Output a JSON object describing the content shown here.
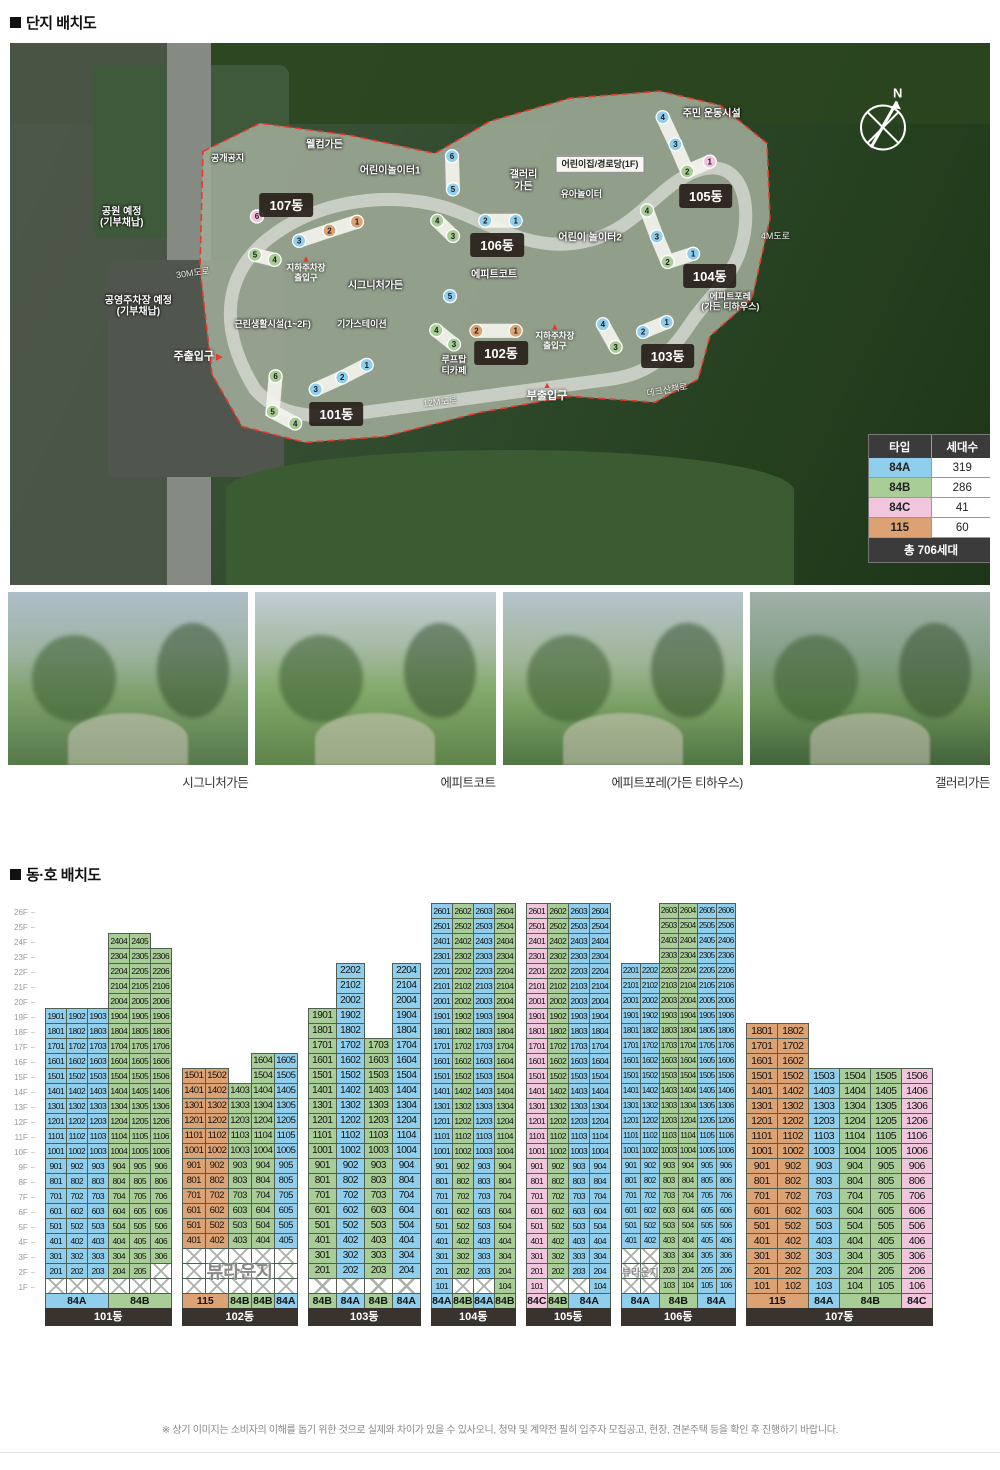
{
  "page": {
    "section1_title": "단지 배치도",
    "section2_title": "동·호 배치도",
    "compass_label": "N",
    "disclaimer": "※ 상기 이미지는 소비자의 이해를 돕기 위한 것으로 실제와 차이가 있을 수 있사오니, 청약 및 계약전 필히 입주자 모집공고, 현장, 견본주택 등을 확인 후 진행하기 바랍니다."
  },
  "type_colors": {
    "84A": "#8FCEEC",
    "84B": "#A9CD96",
    "84C": "#F1C6DD",
    "115": "#DCA273"
  },
  "legend": {
    "col_type": "타입",
    "col_count": "세대수",
    "rows": [
      {
        "type": "84A",
        "count": "319"
      },
      {
        "type": "84B",
        "count": "286"
      },
      {
        "type": "84C",
        "count": "41"
      },
      {
        "type": "115",
        "count": "60"
      }
    ],
    "total": "총 706세대"
  },
  "map": {
    "labels": [
      {
        "text": "공개공지",
        "kind": "outline-sm",
        "x": 22.2,
        "y": 21.3
      },
      {
        "text": "웰컴가든",
        "kind": "outline",
        "x": 32.1,
        "y": 18.9
      },
      {
        "text": "어린이놀이터1",
        "kind": "outline",
        "x": 38.8,
        "y": 23.7
      },
      {
        "text": "갤러리\n가든",
        "kind": "outline",
        "x": 52.4,
        "y": 25.5
      },
      {
        "text": "주민 운동시설",
        "kind": "outline",
        "x": 71.6,
        "y": 13.1
      },
      {
        "text": "어린이집/경로당(1F)",
        "kind": "box",
        "x": 60.2,
        "y": 22.4
      },
      {
        "text": "유아놀이터",
        "kind": "outline-sm",
        "x": 58.3,
        "y": 27.8
      },
      {
        "text": "어린이 놀이터2",
        "kind": "outline",
        "x": 59.2,
        "y": 35.9
      },
      {
        "text": "에피트코트",
        "kind": "outline",
        "x": 49.4,
        "y": 42.8
      },
      {
        "text": "시그니처가든",
        "kind": "outline",
        "x": 37.3,
        "y": 44.8
      },
      {
        "text": "기가스테이션",
        "kind": "outline-sm",
        "x": 35.9,
        "y": 51.9
      },
      {
        "text": "루프탑\n티카페",
        "kind": "outline-sm",
        "x": 45.3,
        "y": 59.5
      },
      {
        "text": "에피트포레\n(가든 티하우스)",
        "kind": "outline-sm",
        "x": 73.5,
        "y": 47.8
      },
      {
        "text": "데크산책로",
        "kind": "road",
        "x": 67.0,
        "y": 64.1,
        "rot": -10
      },
      {
        "text": "12M도로",
        "kind": "road",
        "x": 43.9,
        "y": 66.3,
        "rot": -6
      },
      {
        "text": "4M도로",
        "kind": "road",
        "x": 78.1,
        "y": 35.7,
        "rot": 0
      },
      {
        "text": "30M도로",
        "kind": "road",
        "x": 18.7,
        "y": 42.4,
        "rot": -8
      },
      {
        "text": "공원 예정\n(기부채납)",
        "kind": "outline",
        "x": 11.4,
        "y": 32.2
      },
      {
        "text": "공영주차장 예정\n(기부채납)",
        "kind": "outline",
        "x": 13.1,
        "y": 48.7
      },
      {
        "text": "근린생활시설(1~2F)",
        "kind": "outline-sm",
        "x": 26.8,
        "y": 51.9
      },
      {
        "text": "주출입구",
        "kind": "gate-r",
        "x": 19.2,
        "y": 58.0
      },
      {
        "text": "부출입구",
        "kind": "gate-u",
        "x": 54.8,
        "y": 64.3
      },
      {
        "text": "지하주차장\n출입구",
        "kind": "gate-s",
        "x": 30.2,
        "y": 41.7
      },
      {
        "text": "지하주차장\n출입구",
        "kind": "gate-s",
        "x": 55.6,
        "y": 54.3
      }
    ],
    "badges": [
      {
        "name": "101동",
        "x": 33.3,
        "y": 68.5
      },
      {
        "name": "102동",
        "x": 50.1,
        "y": 57.2
      },
      {
        "name": "103동",
        "x": 67.1,
        "y": 57.8
      },
      {
        "name": "104동",
        "x": 71.4,
        "y": 43.0
      },
      {
        "name": "105동",
        "x": 71.0,
        "y": 28.3
      },
      {
        "name": "106동",
        "x": 49.7,
        "y": 37.2
      },
      {
        "name": "107동",
        "x": 28.2,
        "y": 29.8
      }
    ],
    "map_buildings": [
      {
        "name": "101동",
        "units": [
          {
            "n": 1,
            "t": "84A",
            "x": 36.4,
            "y": 59.4
          },
          {
            "n": 2,
            "t": "84A",
            "x": 33.9,
            "y": 61.7
          },
          {
            "n": 3,
            "t": "84A",
            "x": 31.2,
            "y": 63.9
          },
          {
            "n": 6,
            "t": "84B",
            "x": 27.1,
            "y": 61.5
          },
          {
            "n": 5,
            "t": "84B",
            "x": 26.8,
            "y": 68.0
          },
          {
            "n": 4,
            "t": "84B",
            "x": 29.1,
            "y": 70.2
          }
        ],
        "strips": [
          [
            0,
            1,
            2
          ],
          [
            3,
            4,
            5
          ]
        ]
      },
      {
        "name": "102동",
        "units": [
          {
            "n": 5,
            "t": "84A",
            "x": 44.9,
            "y": 46.7
          },
          {
            "n": 4,
            "t": "84B",
            "x": 43.5,
            "y": 53.0
          },
          {
            "n": 3,
            "t": "84B",
            "x": 45.3,
            "y": 55.6
          },
          {
            "n": 2,
            "t": "115",
            "x": 47.6,
            "y": 53.1
          },
          {
            "n": 1,
            "t": "115",
            "x": 51.6,
            "y": 53.1
          }
        ],
        "strips": [
          [
            1,
            2
          ],
          [
            3,
            4
          ]
        ]
      },
      {
        "name": "103동",
        "units": [
          {
            "n": 4,
            "t": "84A",
            "x": 60.5,
            "y": 51.9
          },
          {
            "n": 3,
            "t": "84B",
            "x": 61.8,
            "y": 56.1
          },
          {
            "n": 2,
            "t": "84A",
            "x": 64.6,
            "y": 53.3
          },
          {
            "n": 1,
            "t": "84A",
            "x": 67.0,
            "y": 51.5
          }
        ],
        "strips": [
          [
            0,
            1
          ],
          [
            2,
            3
          ]
        ]
      },
      {
        "name": "104동",
        "units": [
          {
            "n": 4,
            "t": "84B",
            "x": 65.0,
            "y": 30.9
          },
          {
            "n": 3,
            "t": "84A",
            "x": 66.0,
            "y": 35.7
          },
          {
            "n": 2,
            "t": "84B",
            "x": 67.1,
            "y": 40.4
          },
          {
            "n": 1,
            "t": "84A",
            "x": 69.7,
            "y": 38.9
          }
        ],
        "strips": [
          [
            0,
            1,
            2
          ],
          [
            2,
            3
          ]
        ]
      },
      {
        "name": "105동",
        "units": [
          {
            "n": 4,
            "t": "84A",
            "x": 66.6,
            "y": 13.7
          },
          {
            "n": 3,
            "t": "84A",
            "x": 67.9,
            "y": 18.7
          },
          {
            "n": 2,
            "t": "84B",
            "x": 69.1,
            "y": 23.7
          },
          {
            "n": 1,
            "t": "84C",
            "x": 71.4,
            "y": 21.9
          }
        ],
        "strips": [
          [
            0,
            1,
            2
          ],
          [
            2,
            3
          ]
        ]
      },
      {
        "name": "106동",
        "units": [
          {
            "n": 6,
            "t": "84A",
            "x": 45.1,
            "y": 20.9
          },
          {
            "n": 5,
            "t": "84A",
            "x": 45.2,
            "y": 27.0
          },
          {
            "n": 4,
            "t": "84B",
            "x": 43.6,
            "y": 32.8
          },
          {
            "n": 3,
            "t": "84B",
            "x": 45.2,
            "y": 35.6
          },
          {
            "n": 2,
            "t": "84A",
            "x": 48.5,
            "y": 32.8
          },
          {
            "n": 1,
            "t": "84A",
            "x": 51.6,
            "y": 32.8
          }
        ],
        "strips": [
          [
            0,
            1
          ],
          [
            2,
            3
          ],
          [
            4,
            5
          ]
        ]
      },
      {
        "name": "107동",
        "units": [
          {
            "n": 6,
            "t": "84C",
            "x": 25.2,
            "y": 32.0
          },
          {
            "n": 3,
            "t": "84A",
            "x": 29.5,
            "y": 36.5
          },
          {
            "n": 2,
            "t": "115",
            "x": 32.6,
            "y": 34.6
          },
          {
            "n": 1,
            "t": "115",
            "x": 35.4,
            "y": 33.0
          },
          {
            "n": 5,
            "t": "84B",
            "x": 25.0,
            "y": 39.1
          },
          {
            "n": 4,
            "t": "84B",
            "x": 27.0,
            "y": 40.0
          }
        ],
        "strips": [
          [
            1,
            2,
            3
          ],
          [
            4,
            5
          ]
        ]
      }
    ]
  },
  "photos": [
    {
      "caption": "시그니처가든"
    },
    {
      "caption": "에피트코트"
    },
    {
      "caption": "에피트포레(가든 티하우스)"
    },
    {
      "caption": "갤러리가든"
    }
  ],
  "chart_data": {
    "type": "table",
    "title": "동·호 배치도",
    "floors": [
      "26F",
      "25F",
      "24F",
      "23F",
      "22F",
      "21F",
      "20F",
      "19F",
      "18F",
      "17F",
      "16F",
      "15F",
      "14F",
      "13F",
      "12F",
      "11F",
      "10F",
      "9F",
      "8F",
      "7F",
      "6F",
      "5F",
      "4F",
      "3F",
      "2F",
      "1F"
    ],
    "unit_number_rule": "floor*100 + column_index",
    "lounge_label": "뷰라운지",
    "buildings": [
      {
        "id": "b101",
        "name": "101동",
        "columns": [
          {
            "type": "84A",
            "top": 19,
            "bottom": 2
          },
          {
            "type": "84A",
            "top": 19,
            "bottom": 2
          },
          {
            "type": "84A",
            "top": 19,
            "bottom": 2
          },
          {
            "type": "84B",
            "top": 24,
            "bottom": 2
          },
          {
            "type": "84B",
            "top": 24,
            "bottom": 2
          },
          {
            "type": "84B",
            "top": 23,
            "bottom": 3
          }
        ],
        "labels": [
          {
            "text": "84A",
            "type": "84A",
            "span": 3
          },
          {
            "text": "84B",
            "type": "84B",
            "span": 3
          }
        ],
        "lounge": null
      },
      {
        "id": "b102",
        "name": "102동",
        "columns": [
          {
            "type": "115",
            "top": 15,
            "bottom": 4
          },
          {
            "type": "115",
            "top": 15,
            "bottom": 4
          },
          {
            "type": "84B",
            "top": 14,
            "bottom": 4
          },
          {
            "type": "84B",
            "top": 16,
            "bottom": 4
          },
          {
            "type": "84A",
            "top": 16,
            "bottom": 4
          }
        ],
        "labels": [
          {
            "text": "115",
            "type": "115",
            "span": 2
          },
          {
            "text": "84B",
            "type": "84B",
            "span": 1
          },
          {
            "text": "84B",
            "type": "84B",
            "span": 1
          },
          {
            "text": "84A",
            "type": "84A",
            "span": 1
          }
        ],
        "lounge": {
          "col_start": 1,
          "col_span": 5,
          "font": 18
        }
      },
      {
        "id": "b103",
        "name": "103동",
        "columns": [
          {
            "type": "84B",
            "top": 19,
            "bottom": 2
          },
          {
            "type": "84A",
            "top": 22,
            "bottom": 2
          },
          {
            "type": "84B",
            "top": 17,
            "bottom": 2
          },
          {
            "type": "84A",
            "top": 22,
            "bottom": 2
          }
        ],
        "labels": [
          {
            "text": "84B",
            "type": "84B",
            "span": 1
          },
          {
            "text": "84A",
            "type": "84A",
            "span": 1
          },
          {
            "text": "84B",
            "type": "84B",
            "span": 1
          },
          {
            "text": "84A",
            "type": "84A",
            "span": 1
          }
        ],
        "lounge": null
      },
      {
        "id": "b104",
        "name": "104동",
        "columns": [
          {
            "type": "84A",
            "top": 26,
            "bottom": 1
          },
          {
            "type": "84B",
            "top": 26,
            "bottom": 2
          },
          {
            "type": "84A",
            "top": 26,
            "bottom": 2
          },
          {
            "type": "84B",
            "top": 26,
            "bottom": 1
          }
        ],
        "labels": [
          {
            "text": "84A",
            "type": "84A",
            "span": 1
          },
          {
            "text": "84B",
            "type": "84B",
            "span": 1
          },
          {
            "text": "84A",
            "type": "84A",
            "span": 1
          },
          {
            "text": "84B",
            "type": "84B",
            "span": 1
          }
        ],
        "lounge": null
      },
      {
        "id": "b105",
        "name": "105동",
        "columns": [
          {
            "type": "84C",
            "top": 26,
            "bottom": 1
          },
          {
            "type": "84B",
            "top": 26,
            "bottom": 2
          },
          {
            "type": "84A",
            "top": 26,
            "bottom": 2
          },
          {
            "type": "84A",
            "top": 26,
            "bottom": 1
          }
        ],
        "labels": [
          {
            "text": "84C",
            "type": "84C",
            "span": 1
          },
          {
            "text": "84B",
            "type": "84B",
            "span": 1
          },
          {
            "text": "84A",
            "type": "84A",
            "span": 2
          }
        ],
        "lounge": null
      },
      {
        "id": "b106",
        "name": "106동",
        "columns": [
          {
            "type": "84A",
            "top": 22,
            "bottom": 4
          },
          {
            "type": "84A",
            "top": 22,
            "bottom": 4
          },
          {
            "type": "84B",
            "top": 26,
            "bottom": 1
          },
          {
            "type": "84B",
            "top": 26,
            "bottom": 1
          },
          {
            "type": "84A",
            "top": 26,
            "bottom": 1
          },
          {
            "type": "84A",
            "top": 26,
            "bottom": 1
          }
        ],
        "labels": [
          {
            "text": "84A",
            "type": "84A",
            "span": 2
          },
          {
            "text": "84B",
            "type": "84B",
            "span": 2
          },
          {
            "text": "84A",
            "type": "84A",
            "span": 2
          }
        ],
        "lounge": {
          "col_start": 1,
          "col_span": 2,
          "font": 10
        }
      },
      {
        "id": "b107",
        "name": "107동",
        "columns": [
          {
            "type": "115",
            "top": 18,
            "bottom": 1
          },
          {
            "type": "115",
            "top": 18,
            "bottom": 1
          },
          {
            "type": "84A",
            "top": 15,
            "bottom": 1
          },
          {
            "type": "84B",
            "top": 15,
            "bottom": 1
          },
          {
            "type": "84B",
            "top": 15,
            "bottom": 1
          },
          {
            "type": "84C",
            "top": 15,
            "bottom": 1
          }
        ],
        "labels": [
          {
            "text": "115",
            "type": "115",
            "span": 2
          },
          {
            "text": "84A",
            "type": "84A",
            "span": 1
          },
          {
            "text": "84B",
            "type": "84B",
            "span": 2
          },
          {
            "text": "84C",
            "type": "84C",
            "span": 1
          }
        ],
        "lounge": null
      }
    ]
  }
}
